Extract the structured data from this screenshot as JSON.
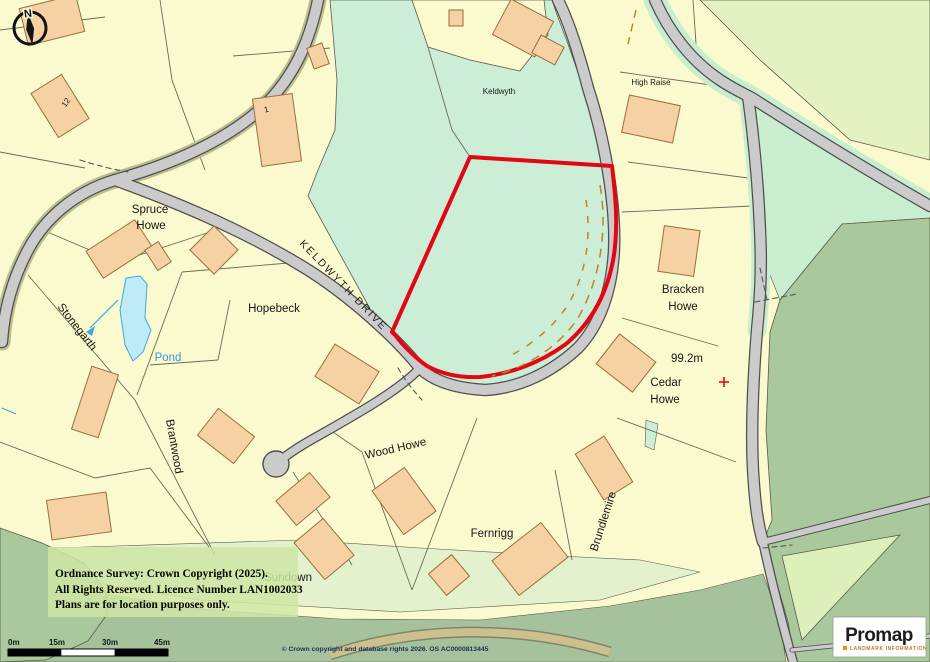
{
  "map": {
    "labels": {
      "spruce_howe": {
        "line1": "Spruce",
        "line2": "Howe"
      },
      "hopebeck": "Hopebeck",
      "stonegarth": "Stonegarth",
      "brantwood": "Brantwood",
      "pond": "Pond",
      "keldwyth_field": "Keldwyth",
      "high_raise": "High Raise",
      "bracken_howe": {
        "line1": "Bracken",
        "line2": "Howe"
      },
      "cedar_howe": {
        "line1": "Cedar",
        "line2": "Howe"
      },
      "wood_howe": "Wood Howe",
      "fernrigg": "Fernrigg",
      "brundlemire": "Brundlemire",
      "sundown": "Sundown",
      "spot_height": "99.2m",
      "house_number_12": "12",
      "house_number_1": "1"
    },
    "road_label": "KELDWYTH DRIVE",
    "compass_label": "N",
    "colors": {
      "parcel": "#fbface",
      "field_mint": "#cdeed6",
      "woodland": "#a9c89b",
      "road_fill": "#cbcbcb",
      "building": "#f6d1a3",
      "pond_fill": "#bfeaf7",
      "boundary_red": "#e30613",
      "overlay_box": "#cfe6a4"
    }
  },
  "overlay": {
    "line1": "Ordnance Survey: Crown Copyright (2025).",
    "line2": "All Rights Reserved. Licence Number LAN1002033",
    "line3": "Plans are for location purposes only."
  },
  "scalebar": {
    "t0": "0m",
    "t15": "15m",
    "t30": "30m",
    "t45": "45m"
  },
  "footer": {
    "os_credit": "© Crown copyright and database rights 2026. OS AC0000813445"
  },
  "logo": {
    "brand": "Promap",
    "tagline": "LANDMARK INFORMATION"
  }
}
